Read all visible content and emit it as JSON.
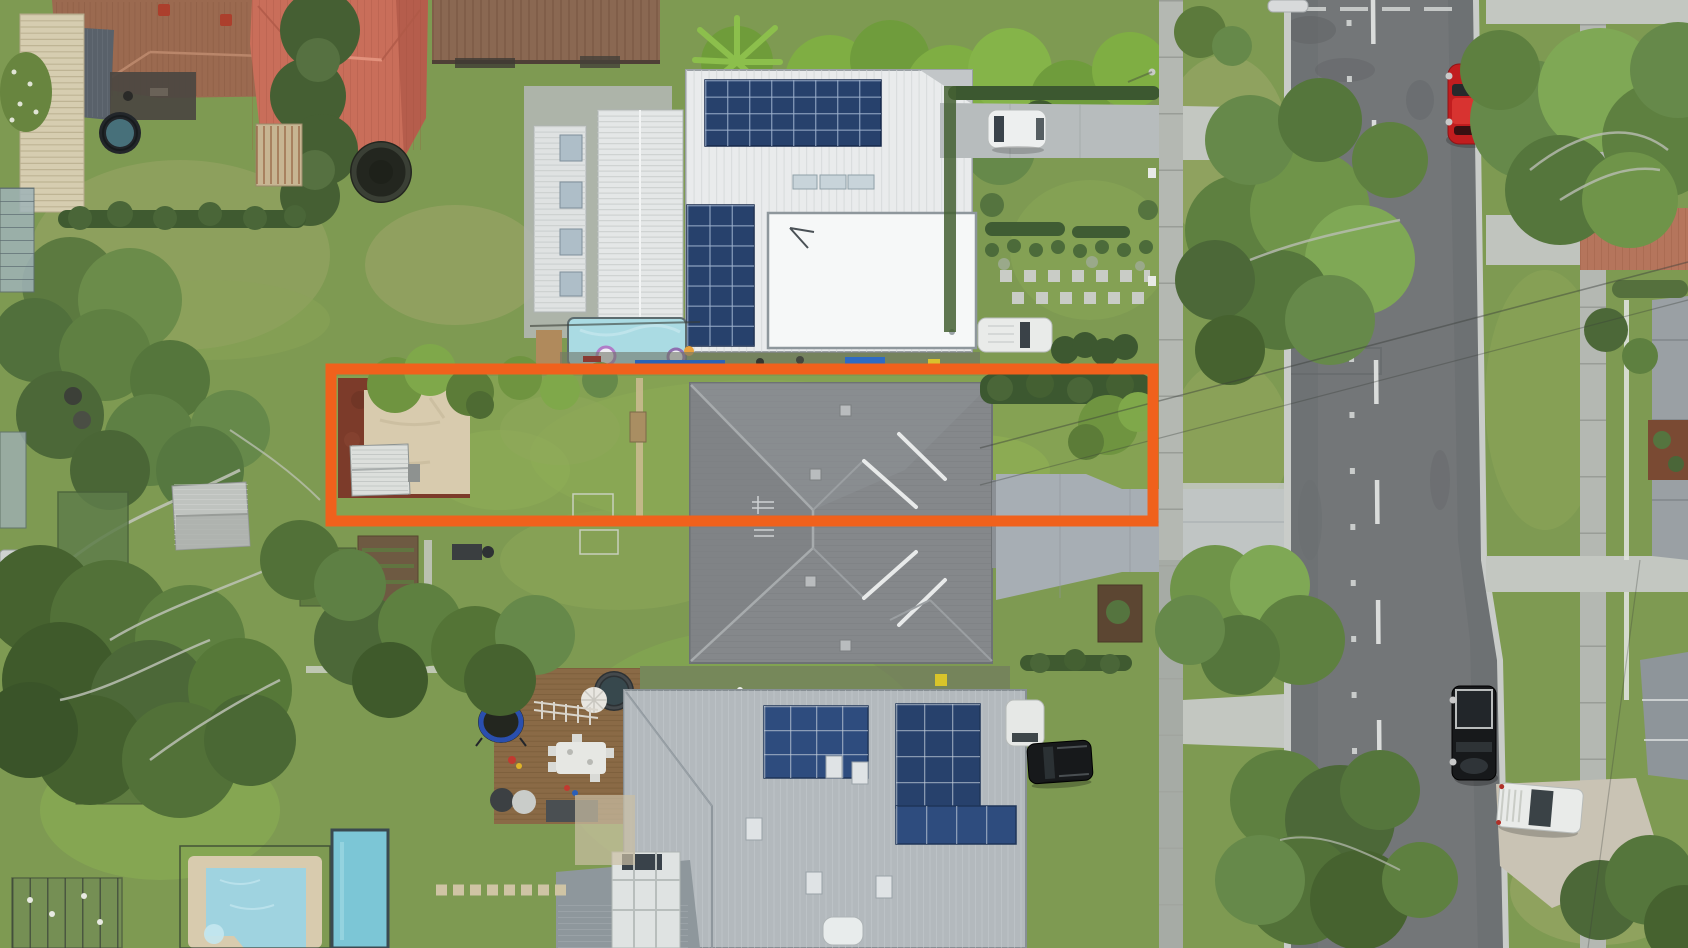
{
  "meta": {
    "kind": "aerial-drone-photograph",
    "subject": "suburban residential block with highlighted property lot for sale",
    "width": 1688,
    "height": 948
  },
  "highlight": {
    "name": "property-boundary",
    "shape": "rectangle",
    "x": 331,
    "y": 369,
    "width": 822,
    "height": 152,
    "stroke_width": 11,
    "color": "#F0611C"
  },
  "palette": {
    "lawn": "#7E9A52",
    "lawn_bright": "#8FBB53",
    "lawn_dry": "#A9AD74",
    "tree_dark": "#4C6838",
    "tree_mid": "#66894A",
    "tree_light": "#7FA855",
    "road": "#737678",
    "kerb": "#C9CCC9",
    "concrete": "#C3C7C1",
    "sidewalk": "#B4B8B2",
    "driveway": "#A7AEB4",
    "white_roof": "#E9EBEC",
    "garage_white": "#F6F8F8",
    "subject_roof": "#85888B",
    "bottom_roof": "#B3B9BD",
    "tile_roof": "#9B6A50",
    "red_roof": "#C96E5A",
    "solar": "#2E4C7E",
    "solar_dark": "#27416C",
    "pool": "#9FD3E0",
    "lap_pool": "#7CC6D6",
    "pool_small": "#AADBE3",
    "deck": "#8A6A46",
    "patio": "#D8CBAE",
    "mulch": "#7C3B2A",
    "shed_white": "#DCDFDC",
    "car_red": "#C11D1F",
    "car_white": "#EDEFEF",
    "car_black": "#17191B",
    "van_white": "#E9EBE9",
    "trampoline_blue": "#2A4FAE",
    "trampoline_black": "#23261F",
    "umbrella": "#E8E6E0",
    "spa": "#2C3134"
  },
  "vehicles": [
    {
      "name": "red-car",
      "location": "parked along right kerb, top",
      "color": "#C11D1F"
    },
    {
      "name": "white-suv",
      "location": "front driveway of white house",
      "color": "#EDEFEF"
    },
    {
      "name": "white-van",
      "location": "rear lane of white house",
      "color": "#E9EBE9"
    },
    {
      "name": "silver-car",
      "location": "partial, top edge of frame",
      "color": "#D8DADB"
    },
    {
      "name": "black-ute",
      "location": "parked along right kerb, lower",
      "color": "#17191B"
    },
    {
      "name": "white-ute",
      "location": "concrete apron, lower right",
      "color": "#E9EBE9"
    },
    {
      "name": "black-suv",
      "location": "driveway of lower house",
      "color": "#17191B"
    }
  ],
  "features": [
    {
      "name": "white-house",
      "note": "white metal roof, two rooftop solar arrays, lap pool"
    },
    {
      "name": "subject-house",
      "note": "grey tiled hip roof inside orange boundary"
    },
    {
      "name": "lower-house",
      "note": "light grey metal roof with large solar arrays, timber deck, spa"
    },
    {
      "name": "street",
      "note": "vertical two-lane road with dashed centre line and pavement markers"
    },
    {
      "name": "backyard",
      "note": "red mulch bed, sand-coloured patio, white garden shed, lawn"
    },
    {
      "name": "pools",
      "note": "two swimming pools lower left, lap pool upper middle"
    },
    {
      "name": "trampolines",
      "note": "three trampolines across neighbouring yards"
    }
  ]
}
